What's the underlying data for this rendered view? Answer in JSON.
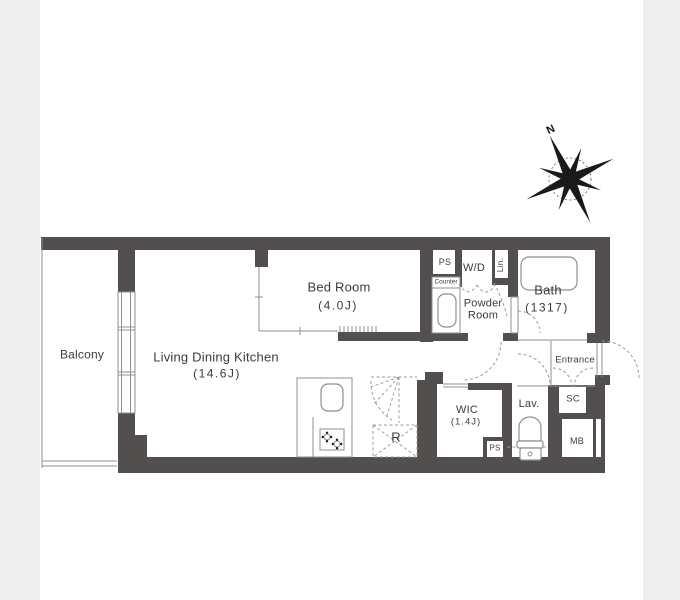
{
  "colors": {
    "wall": "#544f4f",
    "background_side": "#efefef",
    "sheet": "#ffffff",
    "thin_line": "#8f8f8f",
    "dashed_line": "#9b9b9b",
    "text": "#3c3c3c"
  },
  "compass": {
    "north_label": "N"
  },
  "rooms": {
    "balcony": {
      "label": "Balcony"
    },
    "ldk": {
      "label": "Living Dining Kitchen",
      "size": "(14.6J)"
    },
    "bedroom": {
      "label": "Bed Room",
      "size": "(4.0J)"
    },
    "bath": {
      "label": "Bath",
      "size": "(1317)"
    },
    "powder_room": {
      "label": "Powder\nRoom"
    },
    "washer_dryer": {
      "label": "W/D"
    },
    "linen": {
      "label": "Lin."
    },
    "counter": {
      "label": "Counter"
    },
    "pipe_space_top": {
      "label": "PS"
    },
    "pipe_space_bottom": {
      "label": "PS"
    },
    "entrance": {
      "label": "Entrance"
    },
    "shoe_closet": {
      "label": "SC"
    },
    "lavatory": {
      "label": "Lav."
    },
    "wic": {
      "label": "WIC",
      "size": "(1.4J)"
    },
    "mail_box": {
      "label": "MB"
    },
    "refrigerator": {
      "label": "R"
    }
  }
}
